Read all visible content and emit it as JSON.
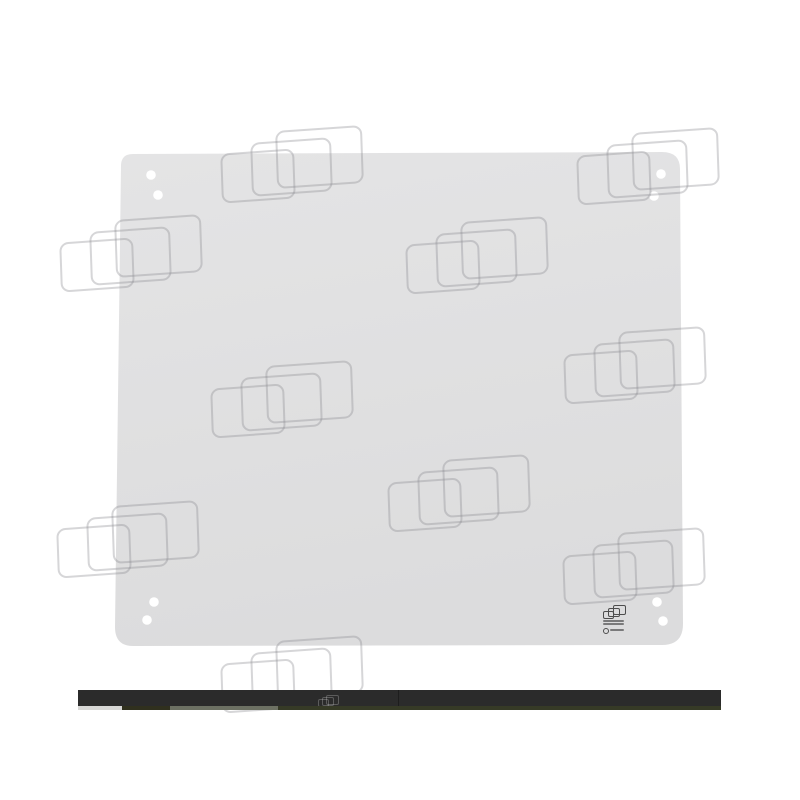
{
  "image": {
    "description": "Watermarked catalog photo of a flat light-gray glass pane with eight mounting holes; top edge of the next dark product photo visible at the bottom",
    "background_color": "#ffffff"
  },
  "glass_panel": {
    "fill_top": "#e4e4e5",
    "fill_bottom": "#dcdcdd",
    "outline_path": "M 133 154 L 662 152 Q 680 152 680 169 L 683 624 Q 683 645 662 645 L 135 646 Q 115 647 115 627 L 121 166 Q 121 154 133 154 Z",
    "holes": [
      {
        "cx": 151,
        "cy": 175,
        "r": 4.8
      },
      {
        "cx": 158,
        "cy": 195,
        "r": 4.8
      },
      {
        "cx": 661,
        "cy": 174,
        "r": 4.8
      },
      {
        "cx": 654,
        "cy": 196,
        "r": 4.8
      },
      {
        "cx": 154,
        "cy": 602,
        "r": 4.8
      },
      {
        "cx": 147,
        "cy": 620,
        "r": 4.8
      },
      {
        "cx": 657,
        "cy": 602,
        "r": 4.8
      },
      {
        "cx": 663,
        "cy": 621,
        "r": 4.8
      }
    ]
  },
  "watermark": {
    "stroke_color": "rgba(138,138,142,0.35)",
    "rects": [
      {
        "dx": 0,
        "dy": 23,
        "w": 70,
        "h": 46
      },
      {
        "dx": 30,
        "dy": 12,
        "w": 77,
        "h": 50
      },
      {
        "dx": 55,
        "dy": 0,
        "w": 83,
        "h": 54
      }
    ],
    "clusters": [
      {
        "x": 221,
        "y": 128
      },
      {
        "x": 577,
        "y": 130
      },
      {
        "x": 60,
        "y": 217
      },
      {
        "x": 406,
        "y": 219
      },
      {
        "x": 564,
        "y": 329
      },
      {
        "x": 211,
        "y": 363
      },
      {
        "x": 388,
        "y": 457
      },
      {
        "x": 57,
        "y": 503
      },
      {
        "x": 563,
        "y": 530
      },
      {
        "x": 221,
        "y": 638
      }
    ]
  },
  "stamp": {
    "color": "#4d4d4d",
    "icon_rects": [
      {
        "dx": 0,
        "dy": 6,
        "w": 9,
        "h": 6
      },
      {
        "dx": 5,
        "dy": 3,
        "w": 10,
        "h": 7
      },
      {
        "dx": 10,
        "dy": 0,
        "w": 11,
        "h": 8
      }
    ],
    "text_lines": [
      {
        "dx": 1,
        "dy": 15,
        "w": 21
      },
      {
        "dx": 1,
        "dy": 18,
        "w": 21
      }
    ],
    "mark_row": {
      "circle_dx": 1,
      "circle_dy": 23,
      "text_dx": 8,
      "text_dy": 24,
      "text_w": 14
    }
  },
  "bottom_bar": {
    "x": 78,
    "y": 690,
    "width": 643,
    "height": 16,
    "color": "#2b2b2b",
    "seam_x": 320,
    "seam_height": 16,
    "substrip_y": 16,
    "substrip_height": 4,
    "substrip_segments": [
      {
        "x": 0,
        "width": 44,
        "color": "#d7d7d5"
      },
      {
        "x": 44,
        "width": 48,
        "color": "#30301e"
      },
      {
        "x": 92,
        "width": 108,
        "color": "#6d7163"
      },
      {
        "x": 200,
        "width": 443,
        "color": "#363a26"
      }
    ],
    "mini_watermark": {
      "x": 240,
      "y": 5,
      "rects": [
        {
          "dx": 0,
          "dy": 4,
          "w": 9,
          "h": 6
        },
        {
          "dx": 4,
          "dy": 2,
          "w": 10,
          "h": 7
        },
        {
          "dx": 8,
          "dy": 0,
          "w": 11,
          "h": 8
        }
      ]
    }
  }
}
